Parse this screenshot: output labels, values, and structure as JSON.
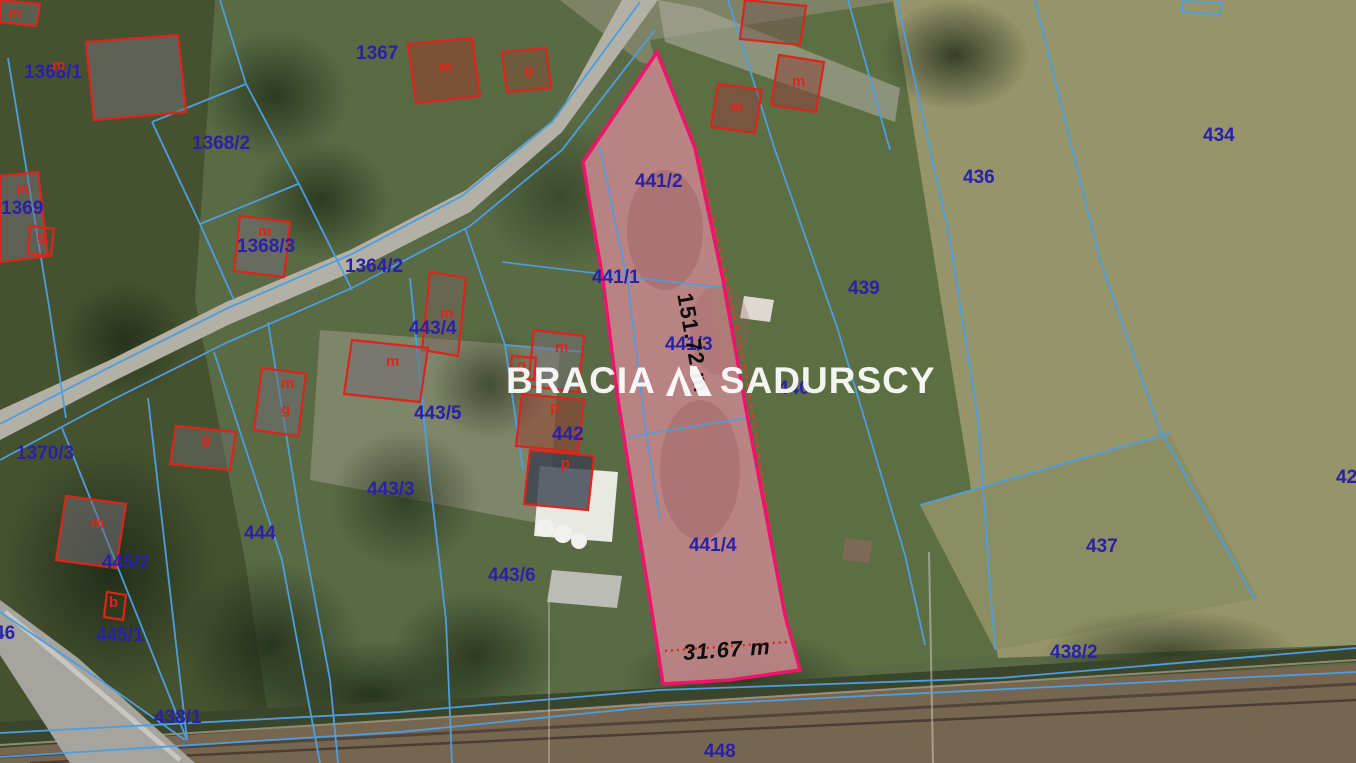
{
  "map": {
    "type": "cadastral-aerial-view",
    "watermark": {
      "brand_left": "BRACIA",
      "brand_right": "SADURSCY"
    },
    "highlight_parcel": {
      "ids": [
        "441/1",
        "441/2",
        "441/3",
        "441/4"
      ],
      "length_label": "151.72 m",
      "width_label": "31.67 m"
    },
    "parcel_labels": [
      "1368/1",
      "1367",
      "1368/2",
      "1369",
      "1368/3",
      "1364/2",
      "443/4",
      "443/5",
      "442",
      "443/3",
      "443/6",
      "444",
      "445/2",
      "445/1",
      "46",
      "1370/3",
      "438/1",
      "448",
      "434",
      "436",
      "439",
      "440",
      "437",
      "438/2",
      "42",
      "441/2",
      "441/1",
      "441/3",
      "441/4"
    ],
    "building_labels": [
      "m",
      "m",
      "m",
      "g",
      "m",
      "m",
      "g",
      "m",
      "m",
      "m",
      "m",
      "m",
      "g",
      "g",
      "m",
      "g",
      "p",
      "p",
      "m",
      "b"
    ],
    "colors": {
      "boundary_blue": "#4d9ee0",
      "label_navy": "#2a21a8",
      "building_red": "#da251d",
      "highlight_magenta": "#ef146b",
      "highlight_fill": "#c3868b",
      "measure_black": "#0d0d0d"
    }
  }
}
